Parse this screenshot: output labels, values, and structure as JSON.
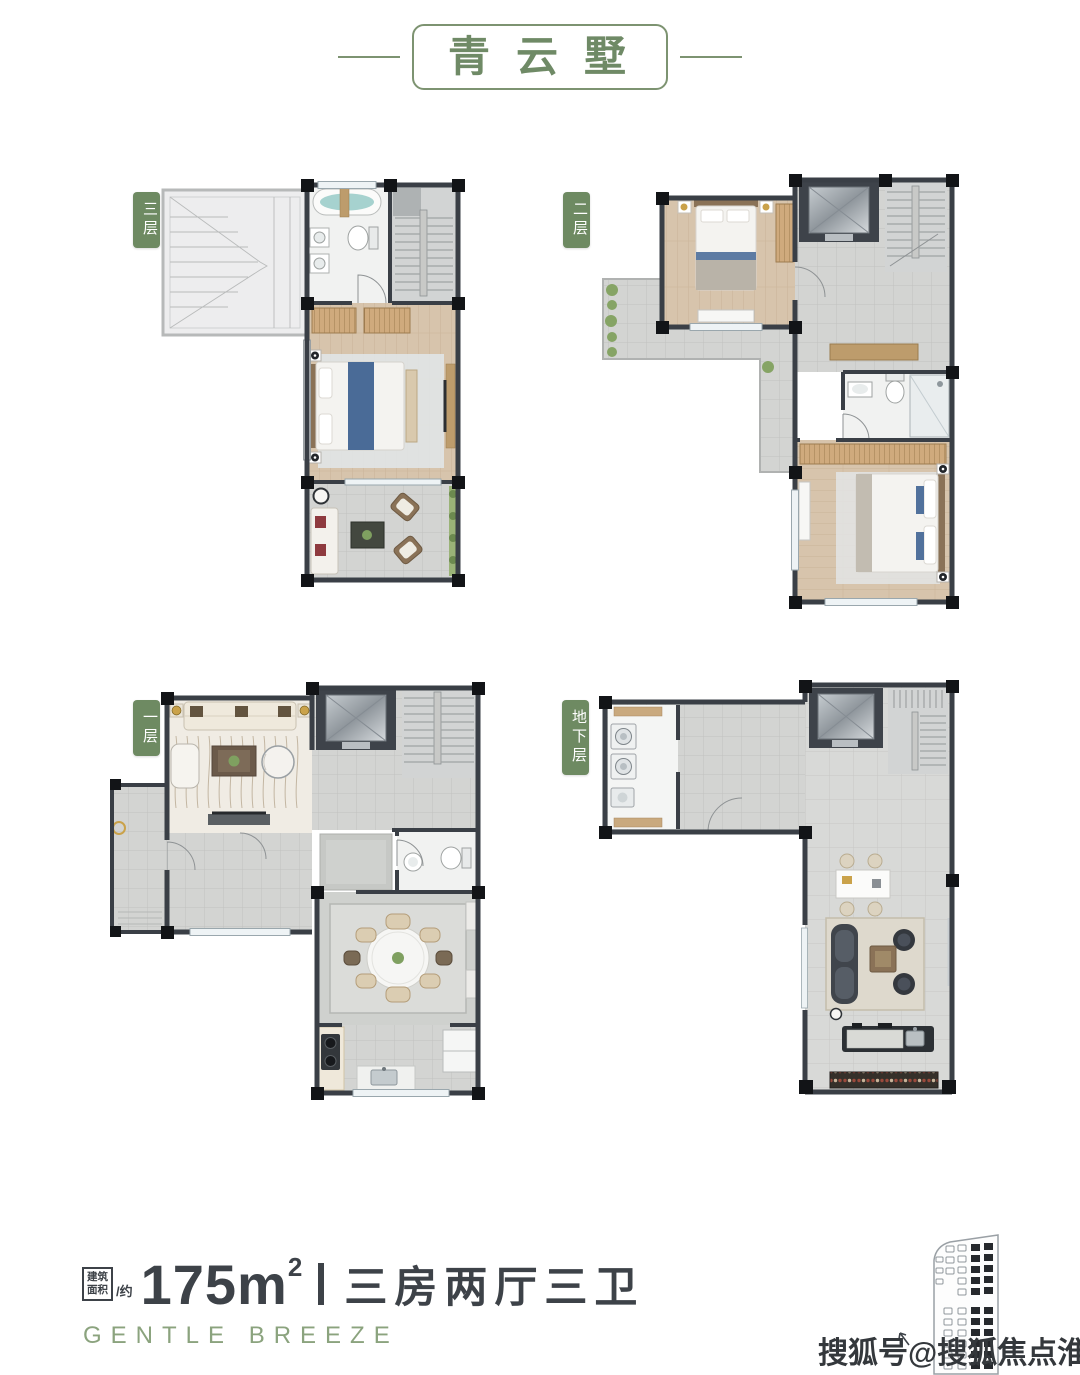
{
  "header": {
    "title": "青云墅"
  },
  "plans": [
    {
      "id": "floor-3",
      "label": "三层"
    },
    {
      "id": "floor-2",
      "label": "二层"
    },
    {
      "id": "floor-1",
      "label": "一层"
    },
    {
      "id": "basement",
      "label": "地下层"
    }
  ],
  "footer": {
    "area_prefix_line1": "建筑",
    "area_prefix_line2": "面积",
    "area_approx": "/约",
    "area_value": "175m",
    "area_superscript": "2",
    "divider": "丨",
    "layout": "三房两厅三卫",
    "tagline": "GENTLE BREEZE"
  },
  "watermark": {
    "text": "搜狐号@搜狐焦点淮南站"
  },
  "colors": {
    "accent_green": "#6e8a62",
    "title_green": "#6f8a66",
    "text_dark": "#3d4248",
    "tagline_green": "#8ba37e",
    "wall_dark": "#3a3f46",
    "wood_floor": "#d7c4ac",
    "tile_floor": "#d3d4d2",
    "bed_blue": "#4a6b97"
  }
}
